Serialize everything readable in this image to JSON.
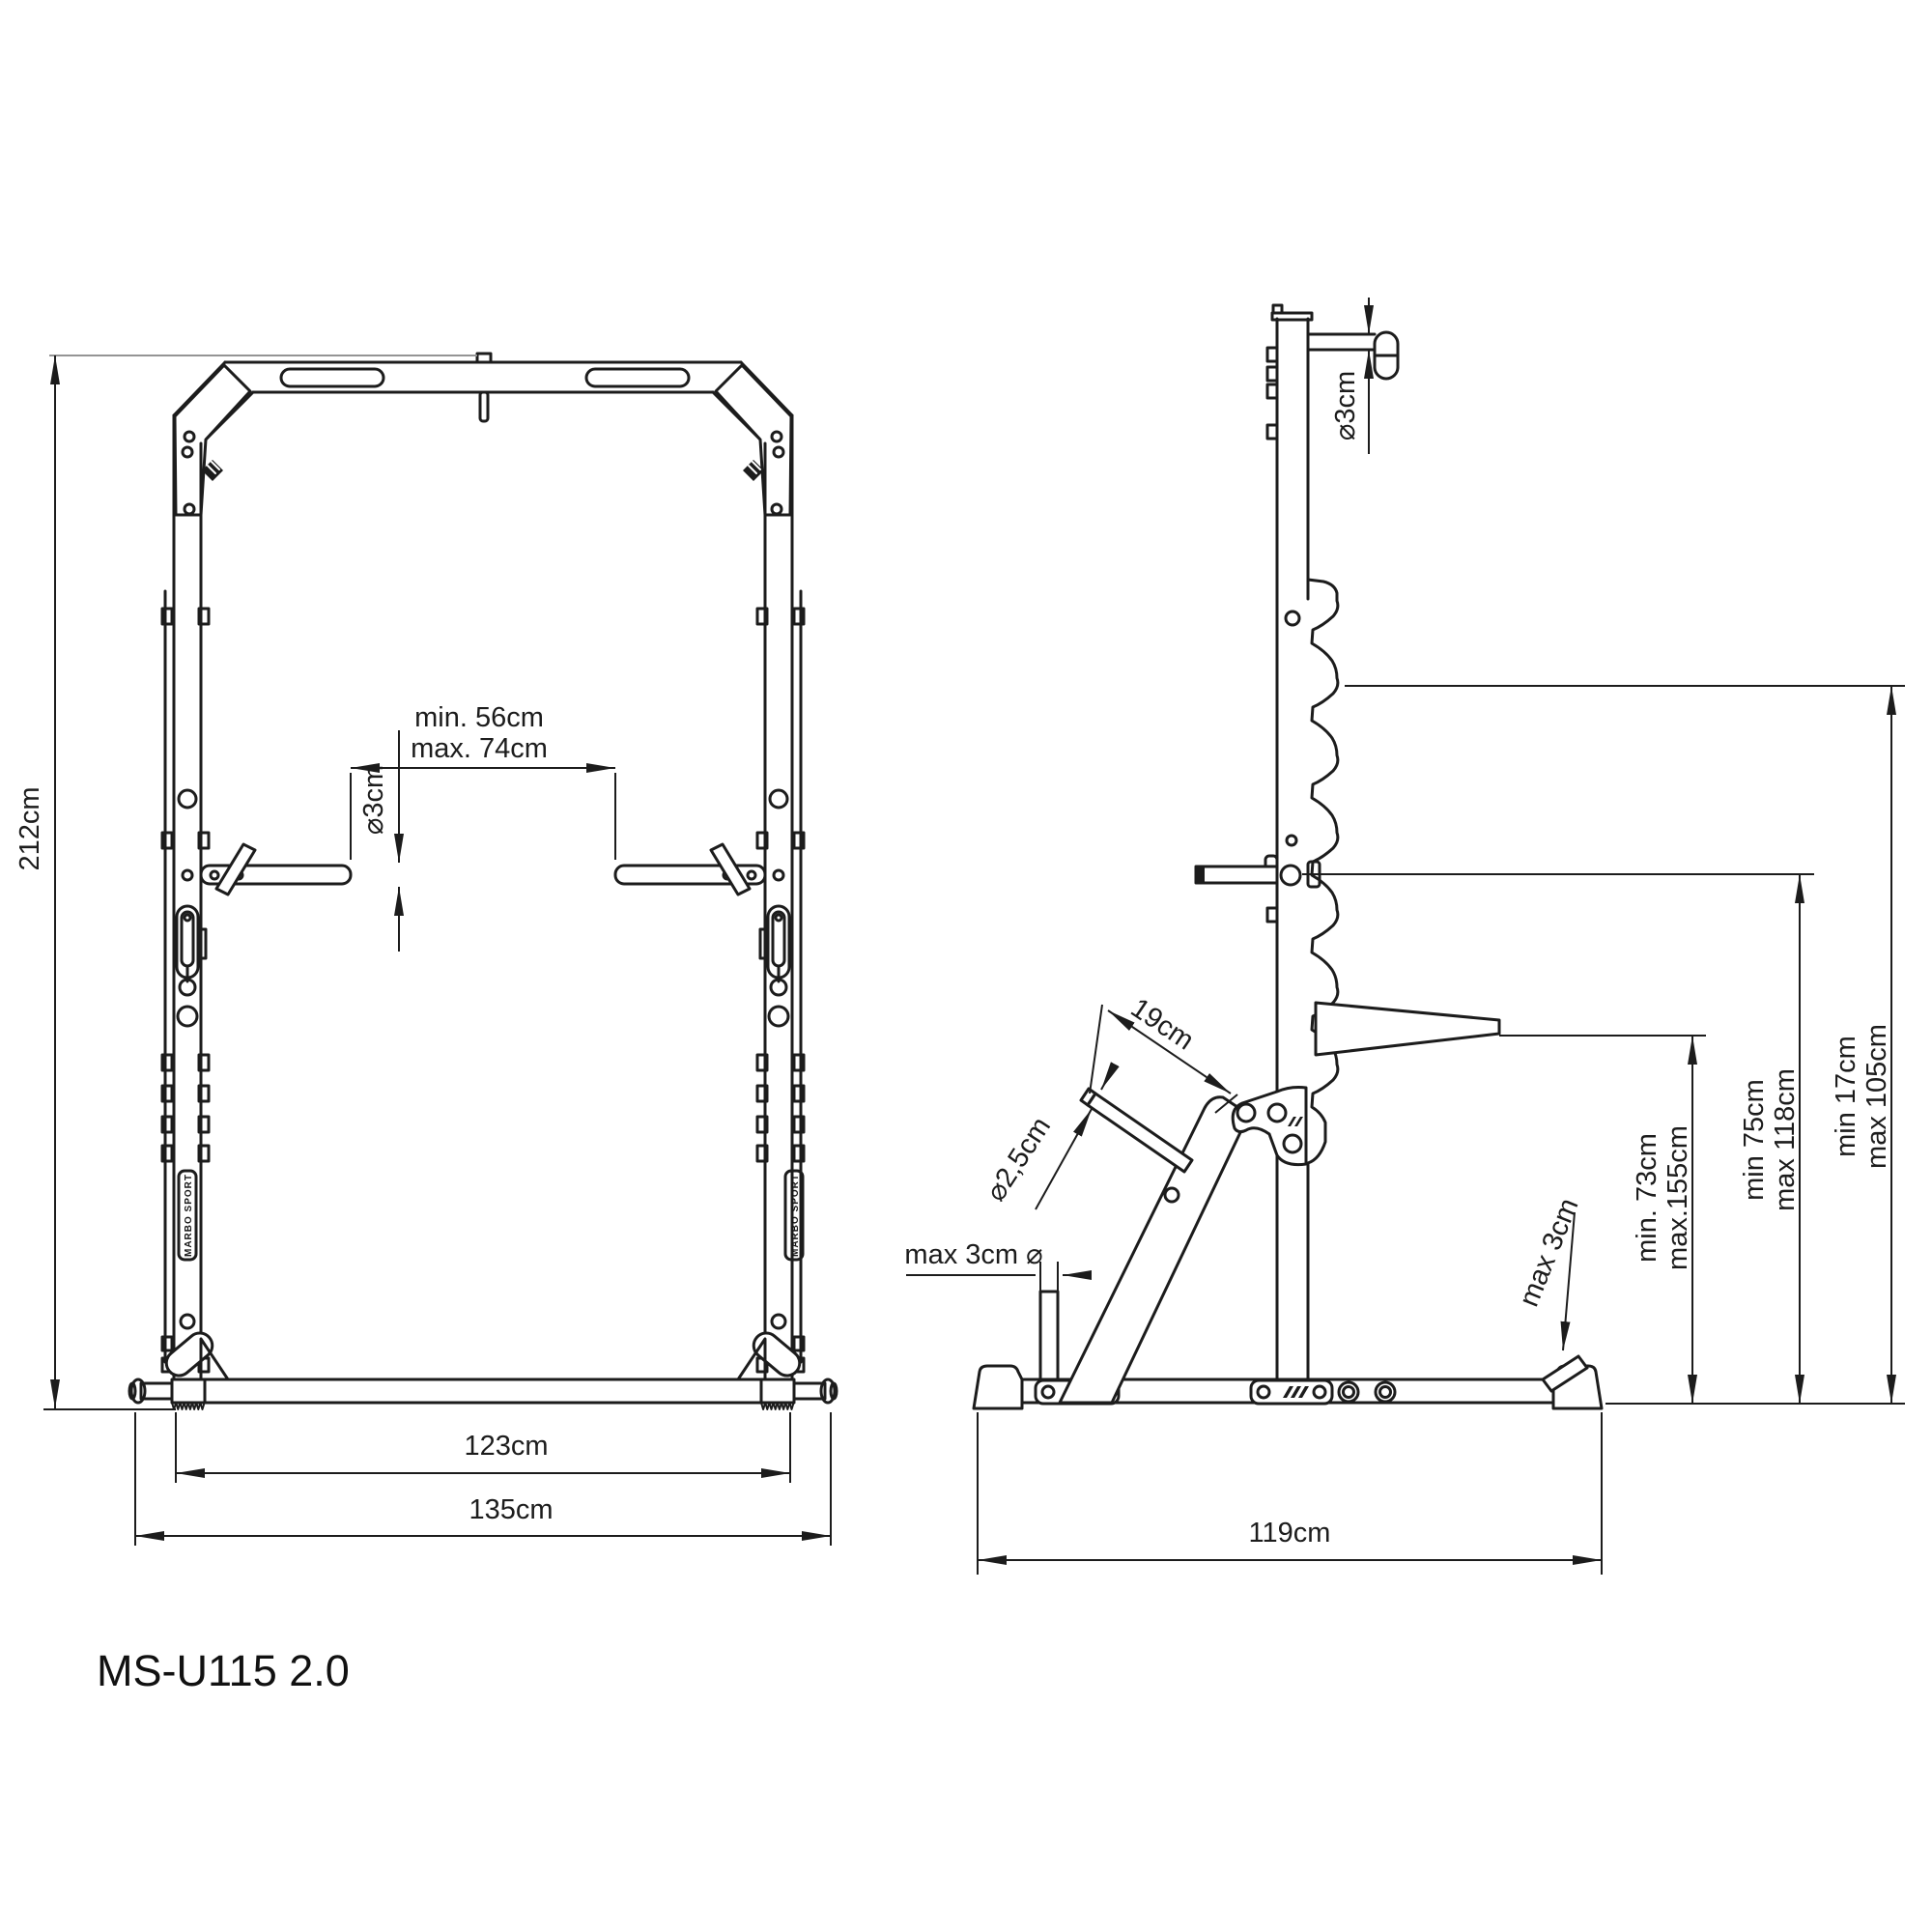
{
  "drawing": {
    "model": "MS-U115 2.0",
    "brand_sticker": "MARBO SPORT",
    "colors": {
      "line": "#1c1c1c",
      "extension": "#949494",
      "background": "#ffffff"
    },
    "front_view": {
      "total_height": "212cm",
      "hook_spacing_min": "min. 56cm",
      "hook_spacing_max": "max. 74cm",
      "hook_diameter": "⌀3cm",
      "inner_width": "123cm",
      "outer_width": "135cm"
    },
    "side_view": {
      "pullup_bar_diameter": "⌀3cm",
      "front_bar_length": "19cm",
      "front_bar_diameter": "⌀2,5cm",
      "peg_diameter": "max 3cm ⌀",
      "wedge_diameter": "max 3cm",
      "spotter_height_min": "min. 73cm",
      "spotter_height_max": "max.155cm",
      "jcup_height_min": "min 75cm",
      "jcup_height_max": "max 118cm",
      "storage_height_min": "min 17cm",
      "storage_height_max": "max 105cm",
      "base_depth": "119cm"
    }
  }
}
